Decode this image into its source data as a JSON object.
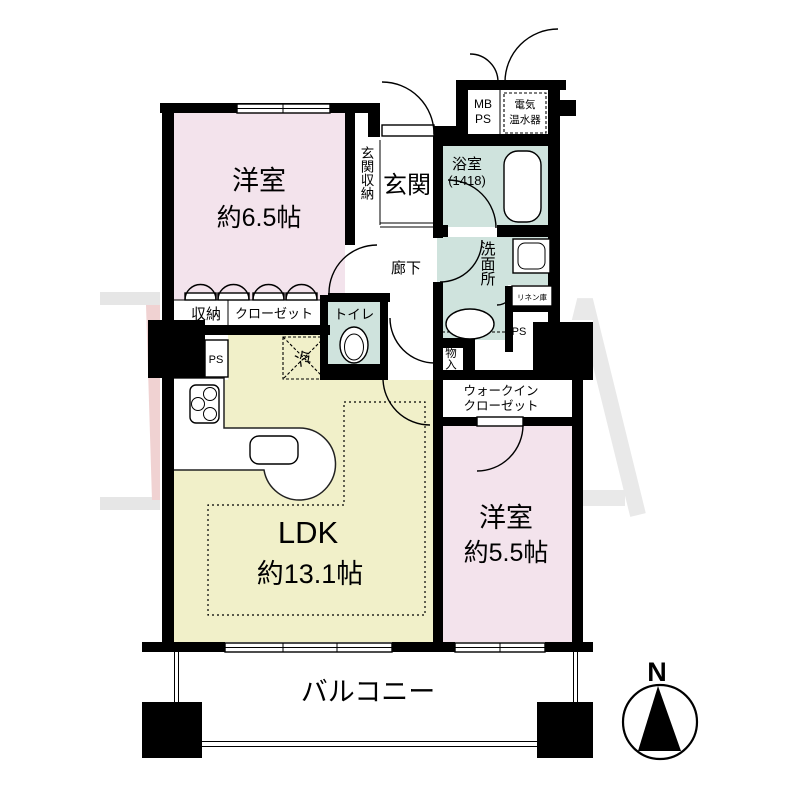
{
  "plan": {
    "bedroom1": {
      "name": "洋室",
      "size": "約6.5帖"
    },
    "bedroom2": {
      "name": "洋室",
      "size": "約5.5帖"
    },
    "ldk": {
      "name": "LDK",
      "size": "約13.1帖"
    },
    "entrance": {
      "label": "玄関"
    },
    "entrance_storage": {
      "label": "玄関収納"
    },
    "corridor": {
      "label": "廊下"
    },
    "bathroom": {
      "label": "浴室",
      "size_note": "(1418)"
    },
    "washroom": {
      "label": "洗面所"
    },
    "toilet": {
      "label": "トイレ",
      "cabinet_note": "上部吊戸棚"
    },
    "wic": {
      "line1": "ウォークイン",
      "line2": "クローゼット"
    },
    "closet": {
      "label": "クローゼット"
    },
    "storage": {
      "label": "収納"
    },
    "small_storage": {
      "label": "物入"
    },
    "linen": {
      "label": "リネン庫"
    },
    "water_heater": {
      "line1": "電気",
      "line2": "温水器"
    },
    "meter_box": {
      "line1": "MB",
      "line2": "PS"
    },
    "pipe_space_left": {
      "label": "PS"
    },
    "pipe_space_right": {
      "label": "PS"
    },
    "refrigerator": {
      "label": "冷"
    },
    "balcony": {
      "label": "バルコニー"
    },
    "compass": {
      "label": "N"
    },
    "colors": {
      "wall": "#000000",
      "bedroom_fill": "#f3e3ec",
      "ldk_fill": "#f1f0c9",
      "wet_area_fill": "#cfe3dd",
      "watermark_gray": "#e9e9e9",
      "watermark_pink": "#f0d2d2"
    }
  }
}
